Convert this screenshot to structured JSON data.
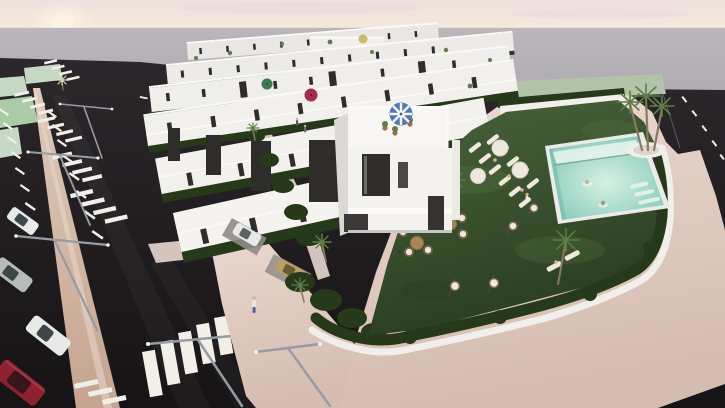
{
  "meta": {
    "description": "Aerial 3D architectural render of a modern white townhouse development at dusk, with rows of terraced houses, rooftop terraces with parasols, a communal pool garden with sun loungers and wicker furniture, palm trees, hedged perimeter walls, pink paved promenades and asphalt streets with zebra crossings, parking bays, street lamps and parked cars."
  },
  "scene": {
    "colors": {
      "sky_top": "#eee1de",
      "sky_horizon": "#f5e9dc",
      "sun_glow": "#fdf4e3",
      "cloud_tint": "#e8d7d8",
      "haze_top": "#bab6bc",
      "haze_bottom": "#aeabb1",
      "asphalt_top": "#2b272a",
      "asphalt_bottom": "#161315",
      "marking_white": "#f2efe9",
      "median_top": "#dfc9b9",
      "median_bottom": "#c5a48f",
      "sidewalk_pale": "#d3c4bd",
      "paving_top": "#ecdad1",
      "paving_bottom": "#d5bcb0",
      "grass_pale": "#c5d9c6",
      "grass_pale2": "#a9cba6",
      "distant_green": "#b3c3aa",
      "building_white": "#f2f0ec",
      "building_bright": "#fbfaf8",
      "building_shade": "#dcd9d4",
      "building_shadowline": "#b7b3af",
      "window_dark": "#2f2e2d",
      "window_mid": "#4a4947",
      "accent_panel": "#2f2d2b",
      "hedge_dark": "#26391b",
      "lawn_top": "#49643c",
      "lawn_bottom": "#2a3e20",
      "lawn_light": "#54703f",
      "pool_coping": "#eceae6",
      "pool_light": "#d6f1e4",
      "pool_deep": "#7cc4b3",
      "pool_step": "#e8f3ec",
      "parasol_blue": "#5577b0",
      "parasol_green": "#3e7a50",
      "parasol_magenta": "#a32c52",
      "parasol_tan": "#cdb86a",
      "parasol_cream": "#ece8dd",
      "palm_green": "#5d7f45",
      "palm_pale": "#cfdcb8",
      "trunk_brown": "#8a7a5f",
      "planter_white": "#f0eeea",
      "wicker_tan": "#a8865a",
      "wicker_dark": "#77634a",
      "cushion_cream": "#efe9dd",
      "lamp_grey": "#969ca6",
      "stand_dark": "#4e4738",
      "pot_terracotta": "#b06a4a",
      "car_red": "#8c2130",
      "car_white": "#e8eae8",
      "car_silver": "#b7bcb8",
      "car_dark": "#2c2c2e",
      "car_tan": "#b89f62",
      "glass_dark": "#3f464a",
      "skin": "#d8b092",
      "jeans_blue": "#47639c"
    },
    "objects": [
      {
        "name": "sky",
        "label": "Pale dawn sky with low sun glow at the left"
      },
      {
        "name": "sea-haze",
        "label": "Grey horizon band behind the development"
      },
      {
        "name": "townhouse-rows",
        "label": "Parallel rows of white terraced townhouses with rooftop terraces and dark window slits",
        "rows": 6
      },
      {
        "name": "rooftop-parasols",
        "count": 4,
        "colors": [
          "green",
          "magenta",
          "tan",
          "blue-striped"
        ]
      },
      {
        "name": "corner-building",
        "label": "Three-storey corner house with roof terrace, striped parasol and plant pots"
      },
      {
        "name": "communal-pool",
        "label": "Rectangular pool with white coping, shallow ledge, corner steps and two swimmers"
      },
      {
        "name": "sun-lounger-area",
        "label": "White sun loungers with cream parasols on the lawn beside the pool",
        "loungers": 11,
        "parasols": 3
      },
      {
        "name": "garden-lounge",
        "label": "Lawn with wicker armchairs, round rattan tables, hanging egg chairs and guests"
      },
      {
        "name": "palm-trees",
        "label": "Palm trees around the pool, gardens and street corners",
        "count": 9
      },
      {
        "name": "perimeter-hedge",
        "label": "Curved white wall topped with clipped dark hedge around the communal garden"
      },
      {
        "name": "paved-promenade",
        "label": "Pink brick-paved sidewalk wrapping the corner of the block"
      },
      {
        "name": "left-road",
        "label": "Asphalt avenue with beige median strip, parking bays and lane markings"
      },
      {
        "name": "zebra-crossings",
        "count": 7
      },
      {
        "name": "street-lamps",
        "count": 5
      },
      {
        "name": "cars",
        "count": 7,
        "colors": [
          "white",
          "silver",
          "red",
          "dark-grey",
          "white",
          "tan",
          "white"
        ]
      },
      {
        "name": "pedestrian",
        "label": "Person in white top and blue jeans walking on the promenade"
      },
      {
        "name": "grass-patches",
        "label": "Pale green grass verges beside the far parking area"
      }
    ]
  }
}
